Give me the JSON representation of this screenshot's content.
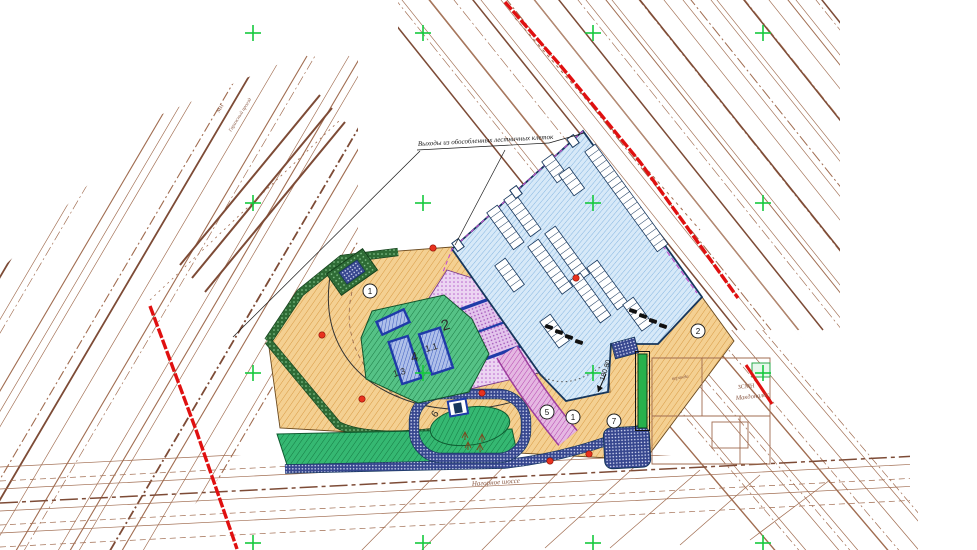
{
  "drawing": {
    "type": "site-plan",
    "annotations": {
      "exits_note": "Выходы из обособленных лестничных клеток",
      "street_name": "Нагорное шоссе",
      "garage_abbr": "МН",
      "garage_street": "Гаражный проезд",
      "bldg_abbr": "ЗСМН",
      "bldg_name": "Макдоналдс",
      "terrace": "веранда",
      "elevation": "180.80"
    },
    "zone_labels": [
      {
        "label": "2"
      },
      {
        "label": "4"
      },
      {
        "label": "1.1"
      },
      {
        "label": "1.3"
      },
      {
        "label": "6"
      }
    ],
    "keynotes": [
      {
        "label": "1"
      },
      {
        "label": "2"
      },
      {
        "label": "5"
      },
      {
        "label": "1"
      },
      {
        "label": "7"
      }
    ],
    "colors": {
      "survey": "#a06c50",
      "survey_dark": "#7d4b36",
      "red": "#e01010",
      "cross": "#15c93d",
      "yard_fill": "#f4d092",
      "yard_hatch": "#d89a44",
      "yard_stroke": "#6b4a1f",
      "parking_fill": "#d7e9f8",
      "parking_hatch": "#85b5e0",
      "parking_stroke": "#16365c",
      "sport_fill": "#ecd4f2",
      "sport_dot": "#b864cc",
      "sport_fill2": "#e3c4ec",
      "sport_dot2": "#a052b8",
      "sport_stroke": "#7a3b8a",
      "court_fill": "#aebfe9",
      "court_hatch": "#3b5bc0",
      "court_stroke": "#1f3ba8",
      "lawn_fill": "#35b872",
      "lawn_hatch": "#157a43",
      "lawn_fill2": "#55c286",
      "lawn_hatch2": "#1b7a44",
      "lawn_stroke": "#0f5c31",
      "hedge_fill": "#2e6b35",
      "hedge_dot": "#8fce96",
      "walk_fill": "#37478f",
      "walk_dot": "#cdd4ee",
      "ramp_fill": "#e5b7e2",
      "ramp_hatch": "#b545b0",
      "ramp_stroke": "#9c3d9c",
      "wall_green": "#27b14c",
      "dot_red": "#e8321e",
      "magenta_line": "#c24fd0"
    }
  }
}
